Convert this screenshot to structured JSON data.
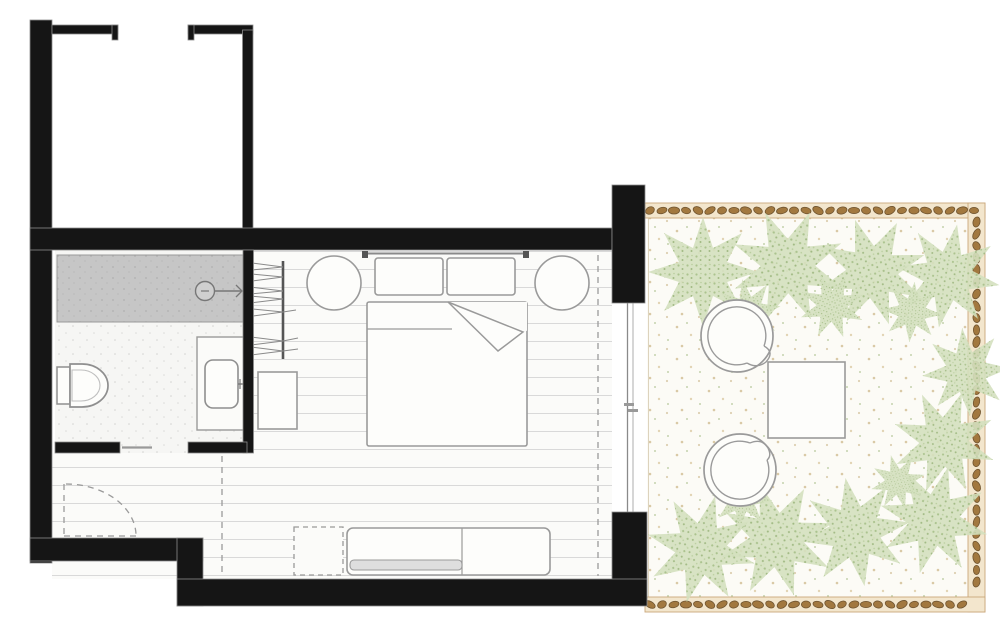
{
  "plan_title": "hotel-room-floor-plan",
  "colors": {
    "wall": "#151515",
    "line": "#9a9a9a",
    "plank_line": "#d9d9d9",
    "shower_fill": "#c6c6c6",
    "shower_dot": "#b0b0b0",
    "bath_floor": "#f6f6f4",
    "pebble_fill": "#a2783f",
    "pebble_stroke": "#6f5430",
    "pebble_band": "#f3e6cd",
    "pebble_band_edge": "#caa77b",
    "plant_fill": "#d4e0bf",
    "plant_dot": "#a3bd85",
    "terrace_bg": "#fcfbf6",
    "terrace_dot": "#d9c9a6",
    "terrace_dot_green": "#c5d3ae"
  },
  "rooms": [
    {
      "name": "entry-closet"
    },
    {
      "name": "bathroom",
      "fixtures": [
        "shower",
        "shower-head",
        "toilet",
        "vanity-sink"
      ]
    },
    {
      "name": "bedroom",
      "fixtures": [
        "wardrobe-rail",
        "hangers",
        "luggage-bench",
        "nightstand-left",
        "nightstand-right",
        "double-bed",
        "pillows",
        "folded-blanket",
        "tv-console",
        "tv",
        "stool-dashed",
        "curtain-line",
        "sliding-glass-door",
        "entry-door-swing",
        "bathroom-sliding-door"
      ]
    },
    {
      "name": "terrace",
      "fixtures": [
        "pebble-border",
        "palm-plants",
        "lounge-chair-top",
        "lounge-chair-bottom",
        "side-table"
      ]
    }
  ],
  "terrace": {
    "pebble_bands": {
      "top": {
        "x1": 650,
        "x2": 981,
        "y": 210.5
      },
      "right": {
        "x": 976.5,
        "y1": 222,
        "y2": 593
      },
      "bottom": {
        "x1": 650,
        "x2": 963,
        "y": 604.5
      }
    },
    "plants": [
      {
        "x": 703,
        "y": 272,
        "s": 1.0,
        "r": 0
      },
      {
        "x": 788,
        "y": 266,
        "s": 1.05,
        "r": 22
      },
      {
        "x": 872,
        "y": 272,
        "s": 1.0,
        "r": -18
      },
      {
        "x": 948,
        "y": 276,
        "s": 0.95,
        "r": 10
      },
      {
        "x": 748,
        "y": 312,
        "s": 0.6,
        "r": 35
      },
      {
        "x": 832,
        "y": 306,
        "s": 0.6,
        "r": -20
      },
      {
        "x": 912,
        "y": 312,
        "s": 0.55,
        "r": 50
      },
      {
        "x": 966,
        "y": 372,
        "s": 0.8,
        "r": 40
      },
      {
        "x": 944,
        "y": 442,
        "s": 0.95,
        "r": -25
      },
      {
        "x": 934,
        "y": 520,
        "s": 1.0,
        "r": 15
      },
      {
        "x": 855,
        "y": 532,
        "s": 1.0,
        "r": -10
      },
      {
        "x": 777,
        "y": 540,
        "s": 1.05,
        "r": 28
      },
      {
        "x": 701,
        "y": 549,
        "s": 1.0,
        "r": -30
      },
      {
        "x": 742,
        "y": 498,
        "s": 0.55,
        "r": -40
      },
      {
        "x": 898,
        "y": 482,
        "s": 0.5,
        "r": 30
      }
    ]
  }
}
